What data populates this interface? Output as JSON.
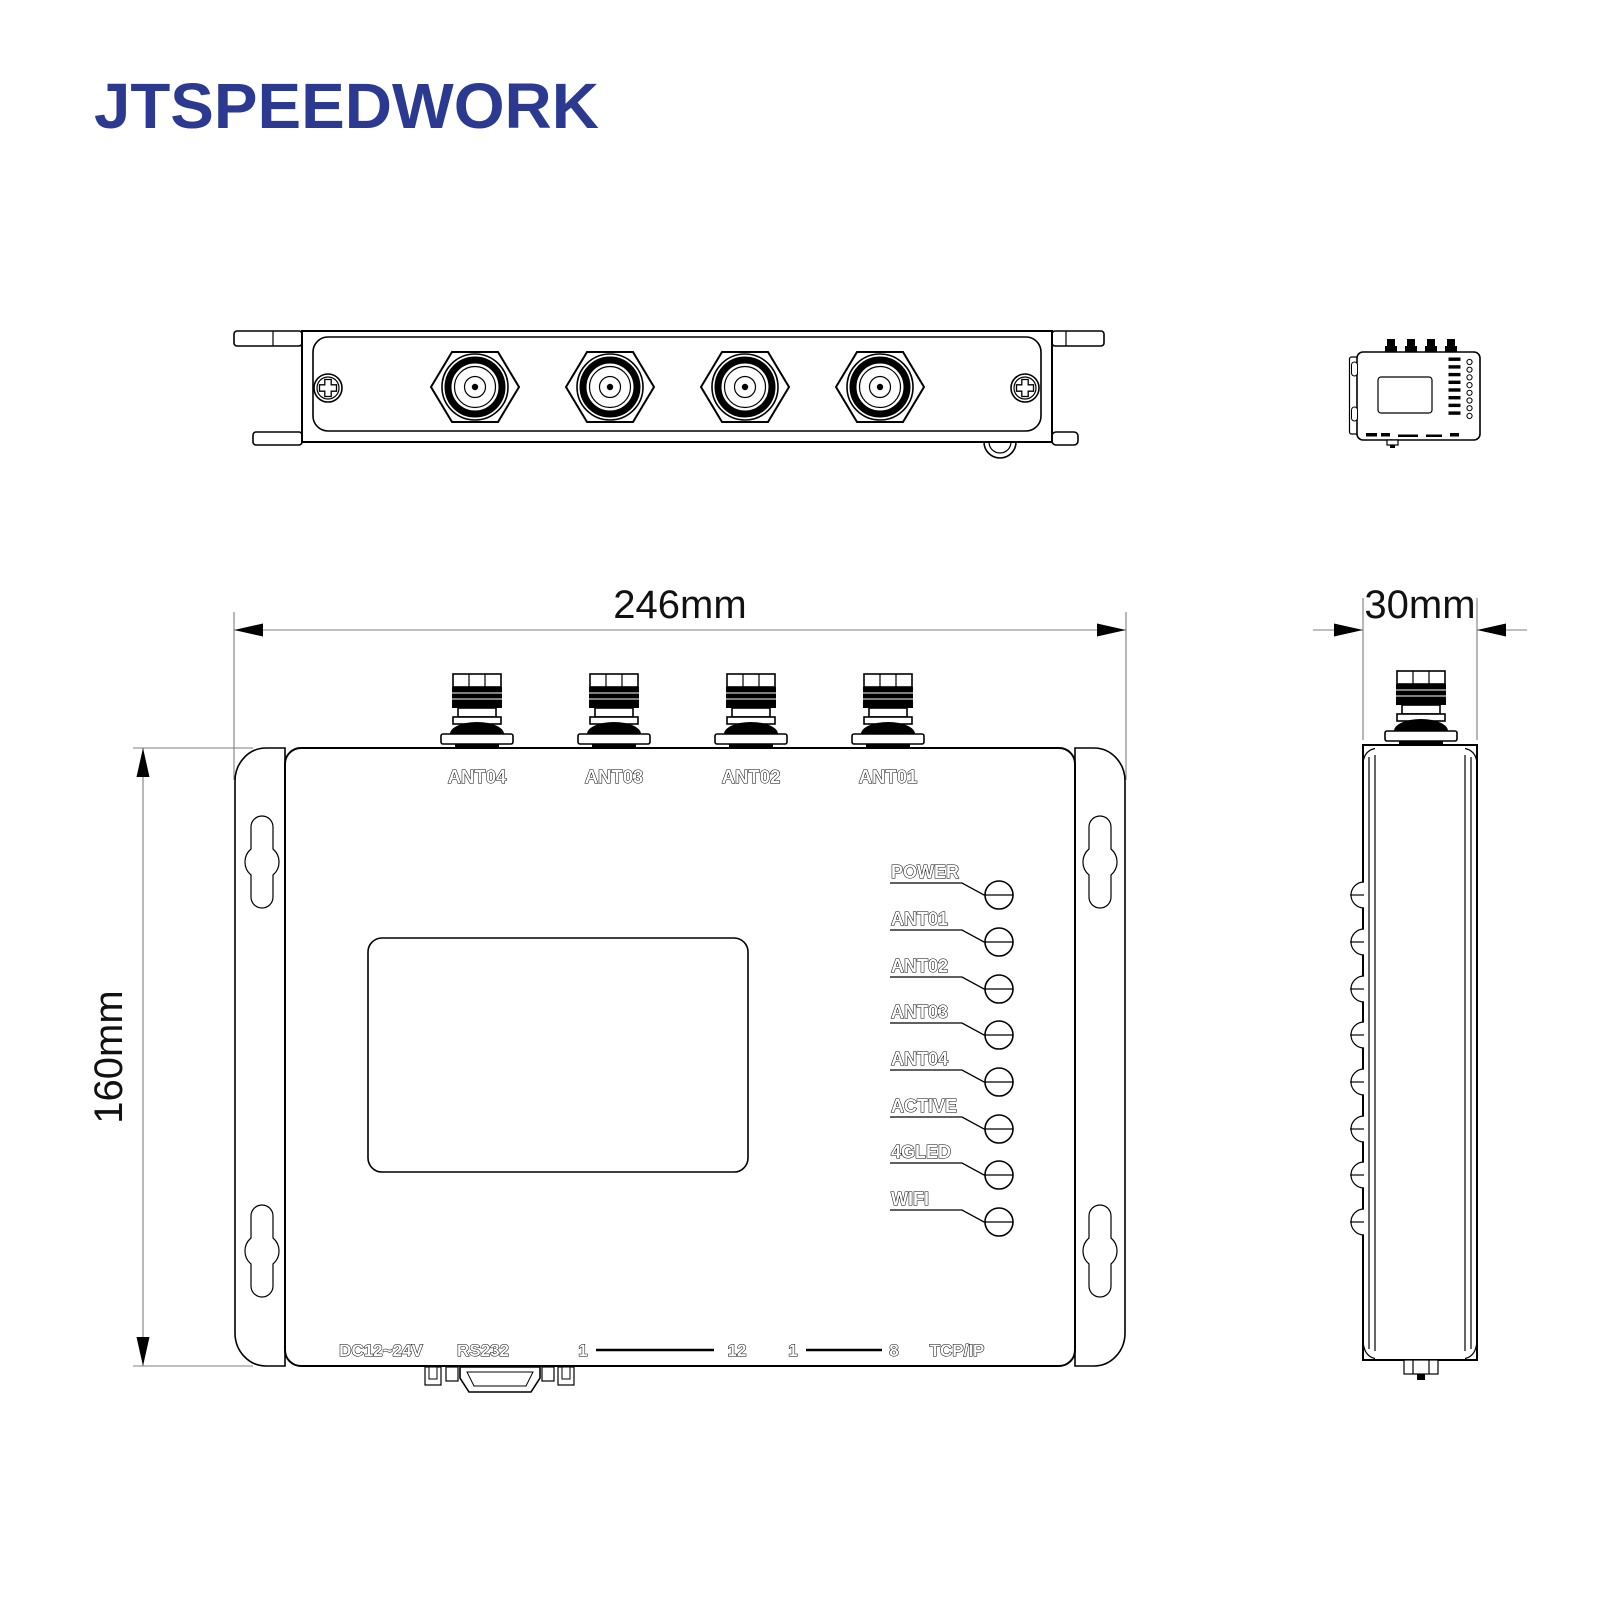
{
  "brand": {
    "name": "JTSPEEDWORK"
  },
  "colors": {
    "brand_blue": "#2B3990",
    "line": "#000000",
    "dim_line": "#7f7f7f"
  },
  "dimensions": {
    "width": "246mm",
    "height": "160mm",
    "depth": "30mm"
  },
  "front_view": {
    "antenna_labels": [
      "ANT04",
      "ANT03",
      "ANT02",
      "ANT01"
    ],
    "led_labels": [
      "POWER",
      "ANT01",
      "ANT02",
      "ANT03",
      "ANT04",
      "ACTIVE",
      "4GLED",
      "WIFI"
    ],
    "bottom_ports": {
      "power": "DC12~24V",
      "serial": "RS232",
      "io_from": "1",
      "io_to": "12",
      "relay_from": "1",
      "relay_to": "8",
      "network": "TCP/IP"
    }
  }
}
